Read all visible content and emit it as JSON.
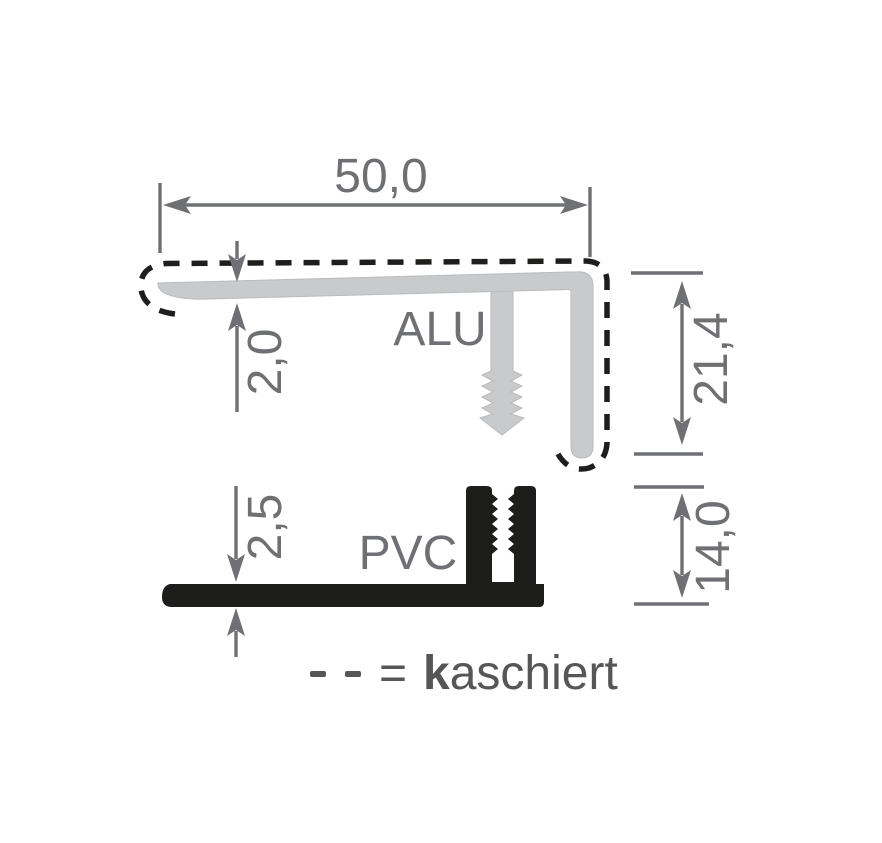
{
  "colors": {
    "background": "#ffffff",
    "alu_fill": "#c9cacc",
    "alu_edge": "#b2b3b5",
    "pvc_fill": "#1d1d1b",
    "dimension_gray": "#6f7073",
    "kaschiert_dash": "#1e1e1c",
    "legend_text": "#565658"
  },
  "profiles": {
    "alu": {
      "label": "ALU",
      "material": "aluminium"
    },
    "pvc": {
      "label": "PVC",
      "material": "pvc"
    }
  },
  "dimensions": {
    "overall_width": "50,0",
    "alu_thickness": "2,0",
    "alu_height": "21,4",
    "pvc_thickness": "2,5",
    "pvc_height": "14,0"
  },
  "legend": {
    "equals": "=",
    "term_initial": "k",
    "term_rest": "aschiert",
    "term_full": "kaschiert"
  }
}
